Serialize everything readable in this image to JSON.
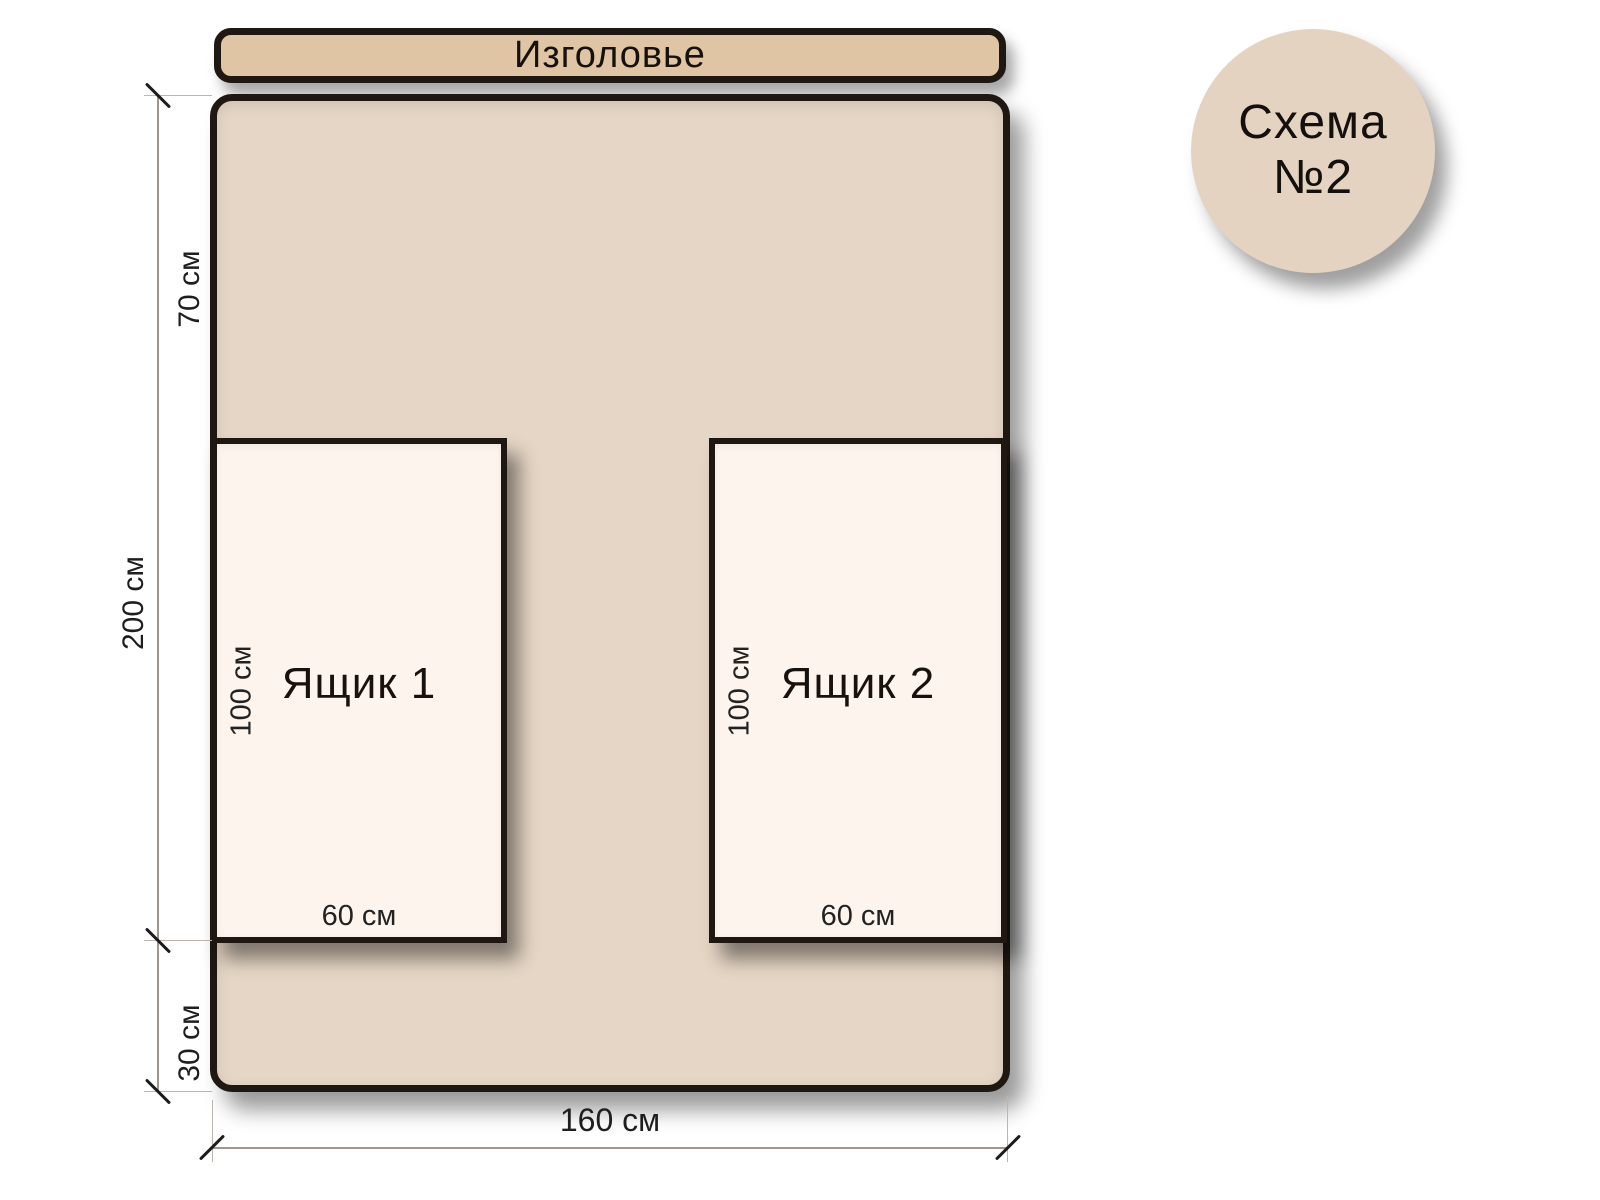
{
  "scheme": {
    "badge": {
      "line1": "Схема",
      "line2": "№2"
    },
    "headboard": {
      "label": "Изголовье"
    },
    "bed": {
      "width_label": "160 см",
      "height_label": "200 см",
      "top_gap_label": "70 см",
      "bottom_gap_label": "30 см"
    },
    "drawers": [
      {
        "name": "Ящик 1",
        "height_label": "100 см",
        "width_label": "60 см"
      },
      {
        "name": "Ящик 2",
        "height_label": "100 см",
        "width_label": "60 см"
      }
    ],
    "colors": {
      "headboard_fill": "#dfc5a4",
      "bed_fill": "#e6d6c5",
      "drawer_fill": "#fdf4ed",
      "badge_fill": "#e5d3c2",
      "outline": "#1f1812"
    }
  }
}
